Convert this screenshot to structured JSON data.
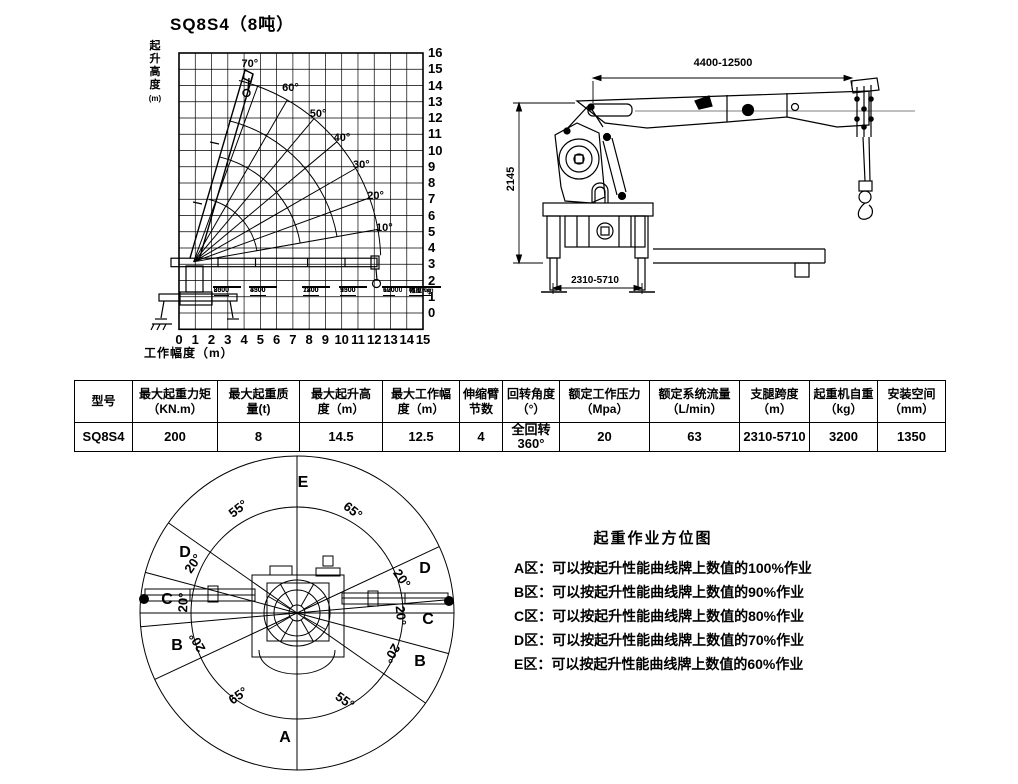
{
  "sheet": {
    "title": "SQ8S4（8吨）"
  },
  "chart_data": {
    "type": "line",
    "title": "SQ8S4（8吨）",
    "xlabel": "工作幅度（m）",
    "ylabel": {
      "text": "起升高度",
      "unit": "(m)"
    },
    "xlim": [
      0,
      15
    ],
    "ylim": [
      0,
      16
    ],
    "grid": true,
    "x_ticks": [
      0,
      1,
      2,
      3,
      4,
      5,
      6,
      7,
      8,
      9,
      10,
      11,
      12,
      13,
      14,
      15
    ],
    "y_ticks": [
      0,
      1,
      2,
      3,
      4,
      5,
      6,
      7,
      8,
      9,
      10,
      11,
      12,
      13,
      14,
      15,
      16
    ],
    "boom_angles_deg": [
      10,
      20,
      30,
      40,
      50,
      60,
      70
    ],
    "pivot_xy_m": [
      0.9,
      3.15
    ],
    "reach_arc_radii_m": [
      3.95,
      6.65,
      8.95,
      11.5
    ],
    "load_points": [
      {
        "load_kg": 8000,
        "radius_mm": 2500
      },
      {
        "load_kg": 3300,
        "radius_mm": 4500
      },
      {
        "load_kg": 1800,
        "radius_mm": 7200
      },
      {
        "load_kg": 1300,
        "radius_mm": 9500
      },
      {
        "load_kg": 600,
        "radius_mm": 12000
      }
    ],
    "box_legend": {
      "load": "荷重Kg",
      "radius": "幅度mm"
    }
  },
  "drawing": {
    "dim_boom_length": "4400-12500",
    "dim_height": "2145",
    "dim_outrigger_span": "2310-5710"
  },
  "spec_table": {
    "columns": [
      "型号",
      "最大起重力矩\n（KN.m）",
      "最大起重质\n量(t)",
      "最大起升高\n度（m）",
      "最大工作幅\n度（m）",
      "伸缩臂\n节数",
      "回转角度\n（°）",
      "额定工作压力\n（Mpa）",
      "额定系统流量\n（L/min）",
      "支腿跨度\n（m）",
      "起重机自重\n（kg）",
      "安装空间\n（mm）"
    ],
    "row": [
      "SQ8S4",
      "200",
      "8",
      "14.5",
      "12.5",
      "4",
      "全回转\n360°",
      "20",
      "63",
      "2310-5710",
      "3200",
      "1350"
    ]
  },
  "zone_diagram": {
    "zone_letters": [
      "E",
      "D",
      "C",
      "B",
      "A",
      "D",
      "C",
      "B"
    ],
    "sector_labels": [
      "55°",
      "65°",
      "20°",
      "20°",
      "20°",
      "20°",
      "20°",
      "20°",
      "65°",
      "55°"
    ]
  },
  "zone_legend": {
    "title": "起重作业方位图",
    "items": [
      "A区：可以按起升性能曲线牌上数值的100%作业",
      "B区：可以按起升性能曲线牌上数值的90%作业",
      "C区：可以按起升性能曲线牌上数值的80%作业",
      "D区：可以按起升性能曲线牌上数值的70%作业",
      "E区：可以按起升性能曲线牌上数值的60%作业"
    ]
  }
}
